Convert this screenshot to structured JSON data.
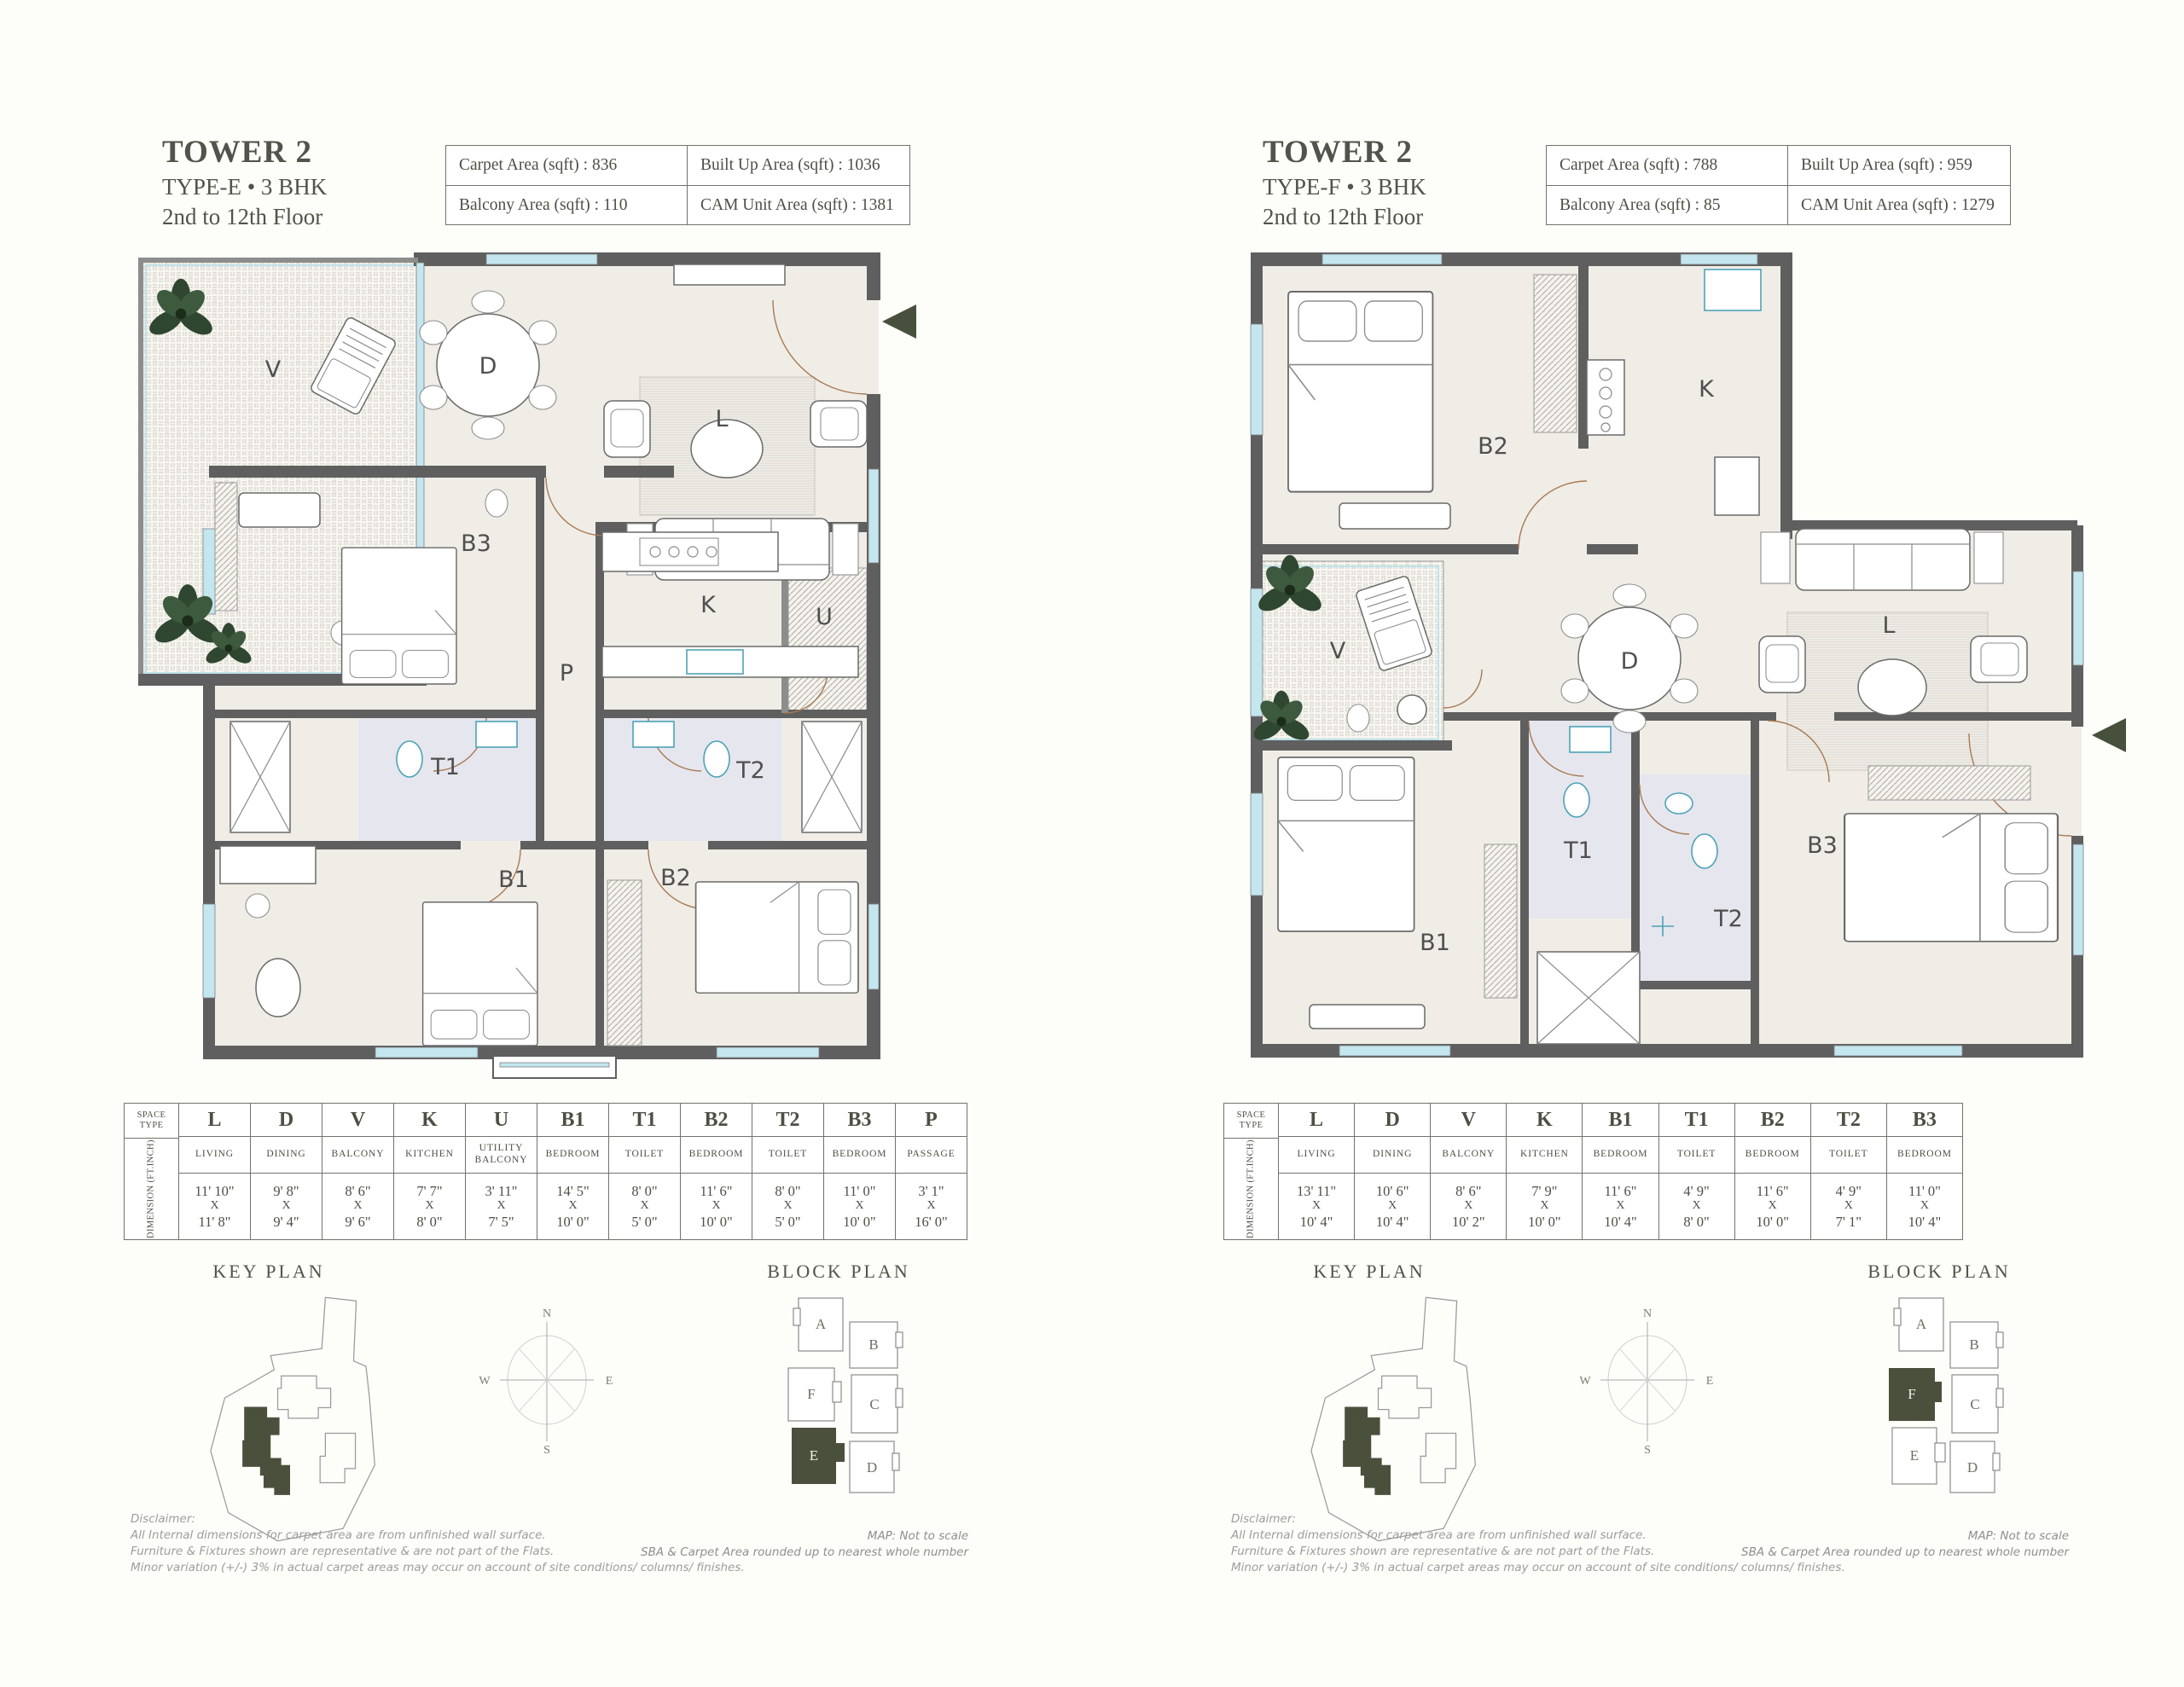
{
  "shared": {
    "key_plan_title": "KEY PLAN",
    "block_plan_title": "BLOCK PLAN",
    "compass": {
      "n": "N",
      "e": "E",
      "s": "S",
      "w": "W"
    },
    "block_labels": {
      "a": "A",
      "b": "B",
      "c": "C",
      "d": "D",
      "e": "E",
      "f": "F"
    },
    "disclaimer": {
      "heading": "Disclaimer:",
      "lines": [
        "All Internal dimensions for carpet area are from unfinished wall surface.",
        "Furniture & Fixtures shown are representative & are not part of the Flats.",
        "Minor variation (+/-) 3% in actual carpet areas may occur on account of site conditions/ columns/ finishes."
      ]
    },
    "map_note": {
      "line1": "MAP: Not to scale",
      "line2": "SBA & Carpet Area rounded up to nearest whole number"
    }
  },
  "left": {
    "title": "TOWER 2",
    "subtitle": "TYPE-E • 3 BHK",
    "floor_range": "2nd to 12th Floor",
    "area_table": {
      "carpet": "Carpet Area (sqft) : 836",
      "built_up": "Built Up Area (sqft) : 1036",
      "balcony": "Balcony Area (sqft) : 110",
      "cam": "CAM Unit Area (sqft) : 1381"
    },
    "block_highlight": "E",
    "rooms": {
      "V": "V",
      "D": "D",
      "L": "L",
      "B3": "B3",
      "K": "K",
      "U": "U",
      "P": "P",
      "T1": "T1",
      "T2": "T2",
      "B1": "B1",
      "B2": "B2"
    },
    "dim_table": {
      "corner": "SPACE TYPE",
      "row_label": "DIMENSION (FT.INCH)",
      "sep": "X",
      "columns": [
        {
          "code": "L",
          "name": "LIVING",
          "d1": "11' 10\"",
          "d2": "11' 8\""
        },
        {
          "code": "D",
          "name": "DINING",
          "d1": "9' 8\"",
          "d2": "9' 4\""
        },
        {
          "code": "V",
          "name": "BALCONY",
          "d1": "8' 6\"",
          "d2": "9' 6\""
        },
        {
          "code": "K",
          "name": "KITCHEN",
          "d1": "7' 7\"",
          "d2": "8' 0\""
        },
        {
          "code": "U",
          "name": "UTILITY BALCONY",
          "d1": "3' 11\"",
          "d2": "7' 5\""
        },
        {
          "code": "B1",
          "name": "BEDROOM",
          "d1": "14' 5\"",
          "d2": "10' 0\""
        },
        {
          "code": "T1",
          "name": "TOILET",
          "d1": "8' 0\"",
          "d2": "5' 0\""
        },
        {
          "code": "B2",
          "name": "BEDROOM",
          "d1": "11' 6\"",
          "d2": "10' 0\""
        },
        {
          "code": "T2",
          "name": "TOILET",
          "d1": "8' 0\"",
          "d2": "5' 0\""
        },
        {
          "code": "B3",
          "name": "BEDROOM",
          "d1": "11' 0\"",
          "d2": "10' 0\""
        },
        {
          "code": "P",
          "name": "PASSAGE",
          "d1": "3' 1\"",
          "d2": "16' 0\""
        }
      ]
    }
  },
  "right": {
    "title": "TOWER 2",
    "subtitle": "TYPE-F • 3 BHK",
    "floor_range": "2nd to 12th Floor",
    "area_table": {
      "carpet": "Carpet Area (sqft) : 788",
      "built_up": "Built Up Area (sqft) : 959",
      "balcony": "Balcony Area (sqft) : 85",
      "cam": "CAM Unit Area (sqft) : 1279"
    },
    "block_highlight": "F",
    "rooms": {
      "B2": "B2",
      "K": "K",
      "V": "V",
      "D": "D",
      "L": "L",
      "T1": "T1",
      "T2": "T2",
      "B3": "B3",
      "B1": "B1"
    },
    "dim_table": {
      "corner": "SPACE TYPE",
      "row_label": "DIMENSION (FT.INCH)",
      "sep": "X",
      "columns": [
        {
          "code": "L",
          "name": "LIVING",
          "d1": "13' 11\"",
          "d2": "10' 4\""
        },
        {
          "code": "D",
          "name": "DINING",
          "d1": "10' 6\"",
          "d2": "10' 4\""
        },
        {
          "code": "V",
          "name": "BALCONY",
          "d1": "8' 6\"",
          "d2": "10' 2\""
        },
        {
          "code": "K",
          "name": "KITCHEN",
          "d1": "7' 9\"",
          "d2": "10' 0\""
        },
        {
          "code": "B1",
          "name": "BEDROOM",
          "d1": "11' 6\"",
          "d2": "10' 4\""
        },
        {
          "code": "T1",
          "name": "TOILET",
          "d1": "4' 9\"",
          "d2": "8' 0\""
        },
        {
          "code": "B2",
          "name": "BEDROOM",
          "d1": "11' 6\"",
          "d2": "10' 0\""
        },
        {
          "code": "T2",
          "name": "TOILET",
          "d1": "4' 9\"",
          "d2": "7' 1\""
        },
        {
          "code": "B3",
          "name": "BEDROOM",
          "d1": "11' 0\"",
          "d2": "10' 4\""
        }
      ]
    }
  }
}
